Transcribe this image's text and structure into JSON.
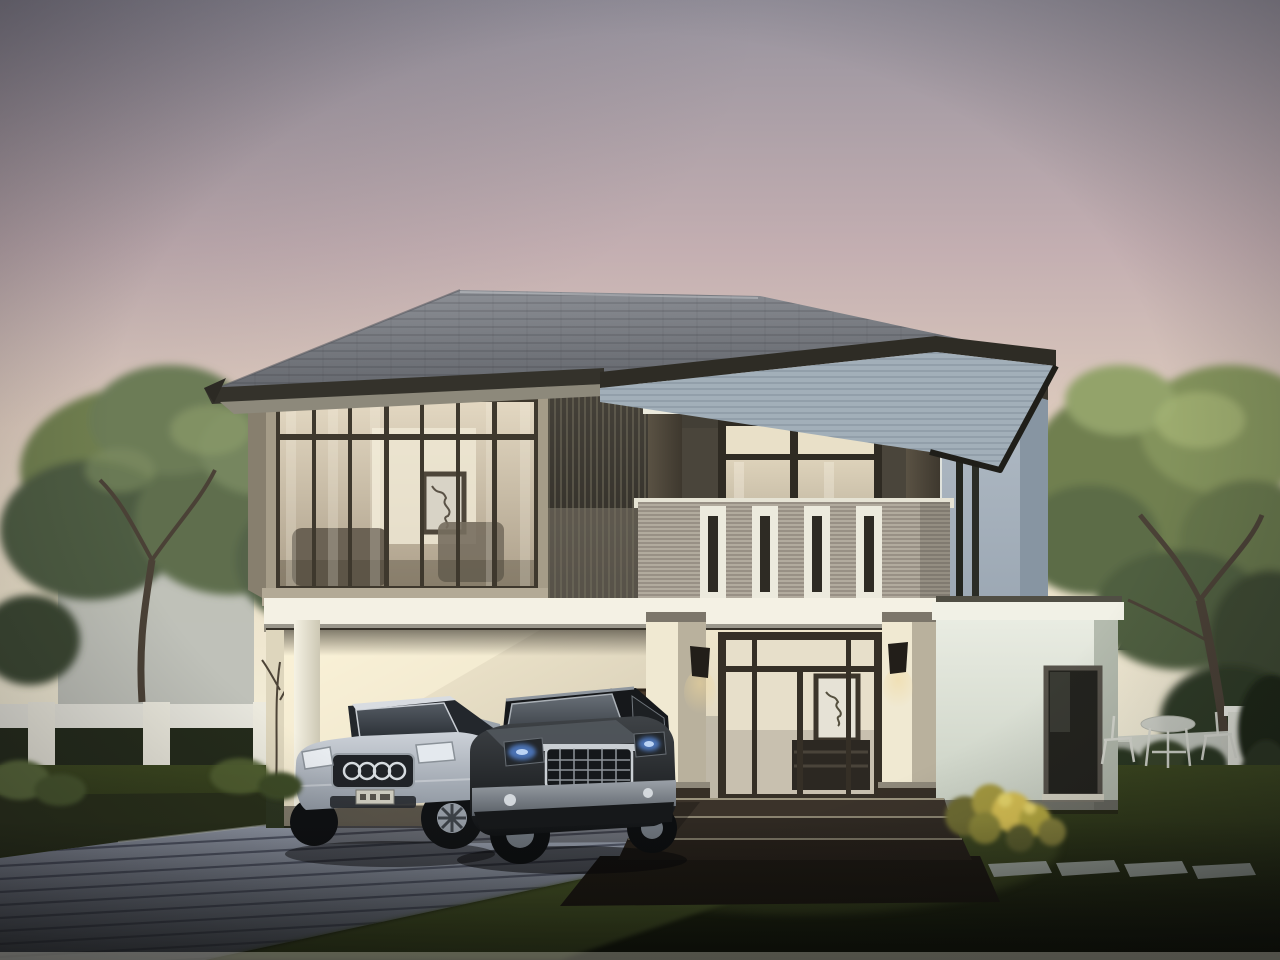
{
  "scene": {
    "type": "3d-architectural-rendering",
    "subject": "modern two-story detached house at dusk with carport, two cars, lawn, paver driveway, perimeter fence, trees and garden",
    "time_of_day": "dusk",
    "objects": [
      "dusk-sky",
      "left-trees",
      "right-tree",
      "left-neighbor-house",
      "right-neighbor-roof",
      "left-white-fence-with-hedges",
      "right-garden-wall",
      "main-house",
      "hip-roof",
      "corner-glass-room",
      "vertical-louver-screen",
      "balcony-with-slotted-parapet",
      "second-floor-columns",
      "carport",
      "entrance-porch-with-glass-doors",
      "porch-steps",
      "right-single-story-wing",
      "silver-sedan",
      "dark-suv",
      "paver-driveway",
      "stepping-stone-path",
      "yellow-flower-bush",
      "white-bistro-set",
      "lawn"
    ]
  },
  "palette": {
    "sky_top": "#97939e",
    "sky_mauve": "#c3aeb1",
    "sky_peach": "#ddcbbd",
    "sky_cream": "#ede3cc",
    "sky_horizon": "#f3eed8",
    "roof_light": "#8f9298",
    "roof_dark": "#63666c",
    "fascia": "#34322b",
    "soffit_left": "#8d897b",
    "soffit_right": "#a2afb9",
    "wall_backdrop": "#3c382f",
    "frame_tan": "#a59c88",
    "mullion": "#3e382d",
    "glass_top": "#e3d8c2",
    "glass_bottom": "#ac9f8a",
    "louver_bg": "#46423a",
    "balcony": "#b2ab9e",
    "slot_white": "#eceadd",
    "slab": "#f4f1e4",
    "porch_wall": "#efe6cc",
    "door_frame": "#352f26",
    "carport_wall": "#f6edd2",
    "carport_shade": "#cfc6b0",
    "corner_light": "#b3bdc7",
    "corner_shade": "#8795a2",
    "column_lit": "#f0e9d2",
    "column_shade": "#b9b19d",
    "column_base": "#362f26",
    "sconce_dark": "#221e19",
    "glow_warm": "#f0d79a",
    "wing_wall": "#e9ece2",
    "wing_shade": "#c9d0c3",
    "window_dark": "#23231e",
    "step_top": "#3b332a",
    "step_mid": "#2f2922",
    "step_bottom": "#251f19",
    "grass_top": "#3b471f",
    "grass_bottom": "#12160b",
    "drive_light": "#959caa",
    "drive_dark": "#5f6573",
    "drive_line": "#474c5c",
    "fence_white": "#e7e6dd",
    "hedge": "#242b1b",
    "neighbor_wall": "#b9bcb6",
    "neighbor_roof": "#3f4540",
    "foliage_hi": "#a3b173",
    "foliage_mid": "#6f7f50",
    "foliage_dark": "#3c4a30",
    "trunk": "#4a4136",
    "car_silver": "#ccd1d8",
    "car_silver_dark": "#8f97a1",
    "car_suv": "#3f4347",
    "car_suv_dark": "#101214",
    "chrome": "#c9ced3",
    "headlight_blue": "#5585d6",
    "flower_yellow": "#d8c153",
    "stone": "#aeb6b0",
    "furniture_white": "#d9dbd2"
  }
}
